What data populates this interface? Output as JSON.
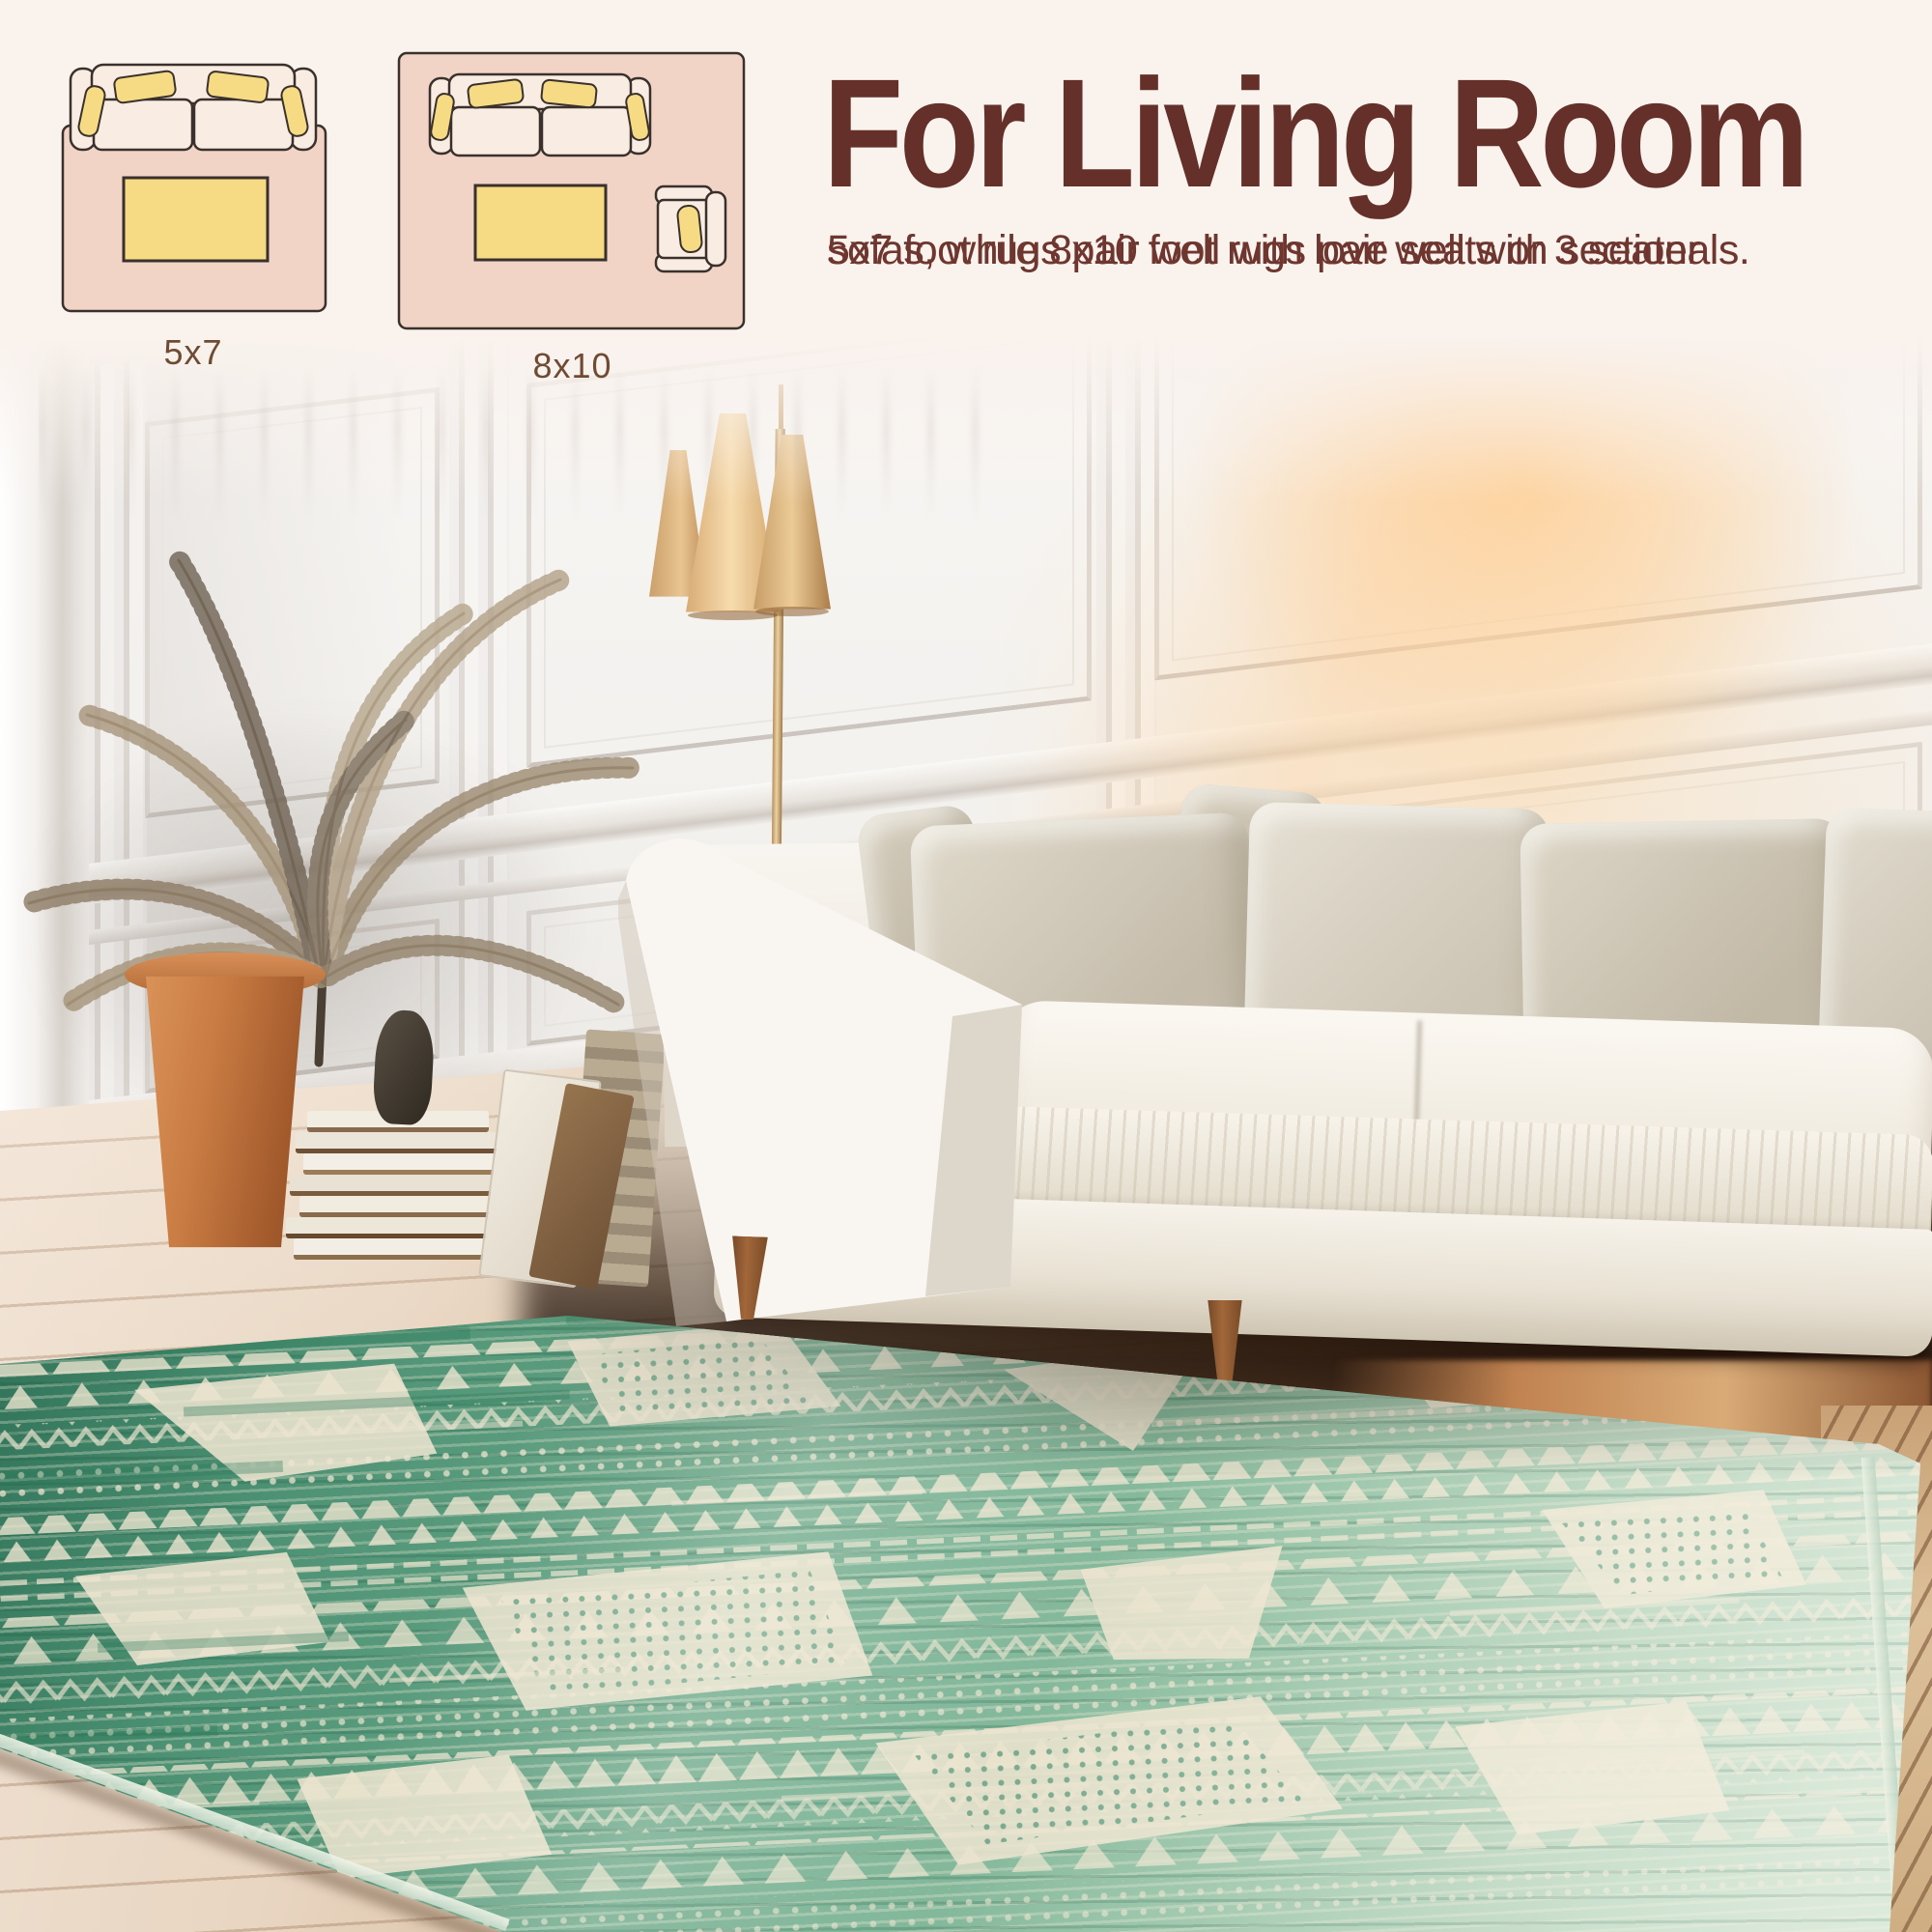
{
  "banner": {
    "background": "#f9f2ed",
    "heading": {
      "text": "For Living Room",
      "color": "#653029"
    },
    "body": {
      "color": "#6e362f",
      "lines": [
        "5x7 foot rugs pair well with love seats or 3 seater",
        "sofas, while 8x10 foot rugs pair well with sectionals."
      ]
    },
    "diagrams": [
      {
        "label": "5x7",
        "furniture": [
          "loveseat",
          "coffee-table"
        ],
        "rug_fill": "#f2d4c7",
        "upholstery_fill": "#f9ece3",
        "accent_fill": "#f6db84",
        "line_color": "#3b312c"
      },
      {
        "label": "8x10",
        "furniture": [
          "sofa",
          "coffee-table",
          "armchair"
        ],
        "rug_fill": "#f2d4c7",
        "upholstery_fill": "#f9ece3",
        "accent_fill": "#f6db84",
        "line_color": "#3b312c"
      }
    ],
    "label_color": "#6f4b34"
  },
  "scene": {
    "objects": [
      "paneled-wall",
      "door-frame",
      "floor-lamp-three-shades",
      "dried-palm-plant",
      "terracotta-planter",
      "book-stack",
      "dark-sculpture",
      "leaning-canvases",
      "white-modern-sofa",
      "greige-throw-pillows",
      "wood-legs",
      "whitewashed-wood-floor",
      "sunlight-glow",
      "green-ikat-area-rug"
    ],
    "palette": {
      "wall": "#f3f1ee",
      "sun_glow": "#f7c28e",
      "sofa": "#f8f5f0",
      "pillow": "#cfc7b8",
      "lamp_shade": "#ecbf88",
      "lamp_pole": "#cfa877",
      "plant": "#a09074",
      "planter": "#c07a44",
      "floor_light": "#e9d8c6",
      "floor_shadow": "#2b1810",
      "rug_green_dark": "#3f8a6c",
      "rug_green_mid": "#74ae92",
      "rug_green_pale": "#b3d2bc",
      "rug_cream": "#ece4cf",
      "leg_wood": "#8a5a33"
    }
  }
}
